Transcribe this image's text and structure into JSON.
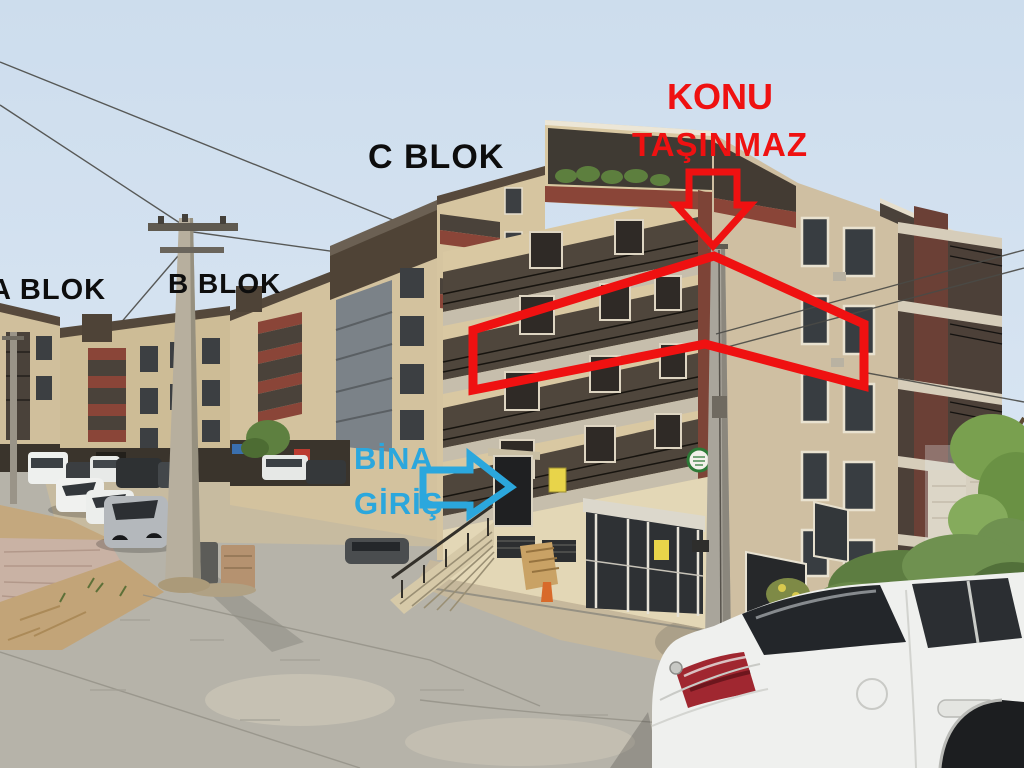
{
  "annotations": {
    "konu_line1": "KONU",
    "konu_line2": "TAŞINMAZ",
    "c_blok": "C BLOK",
    "b_blok": "B BLOK",
    "a_blok": "A BLOK",
    "bina_line1": "BİNA",
    "bina_line2": "GİRİŞ"
  },
  "colors": {
    "annotation_red": "#ef1111",
    "annotation_cyan": "#2ba7dd",
    "annotation_black": "#0d0d0d",
    "sky": "#cddded",
    "building_beige": "#d9c8a2",
    "balcony_dark": "#4f463c",
    "accent_maroon": "#8a4538",
    "road_gray": "#b6b3a9"
  }
}
